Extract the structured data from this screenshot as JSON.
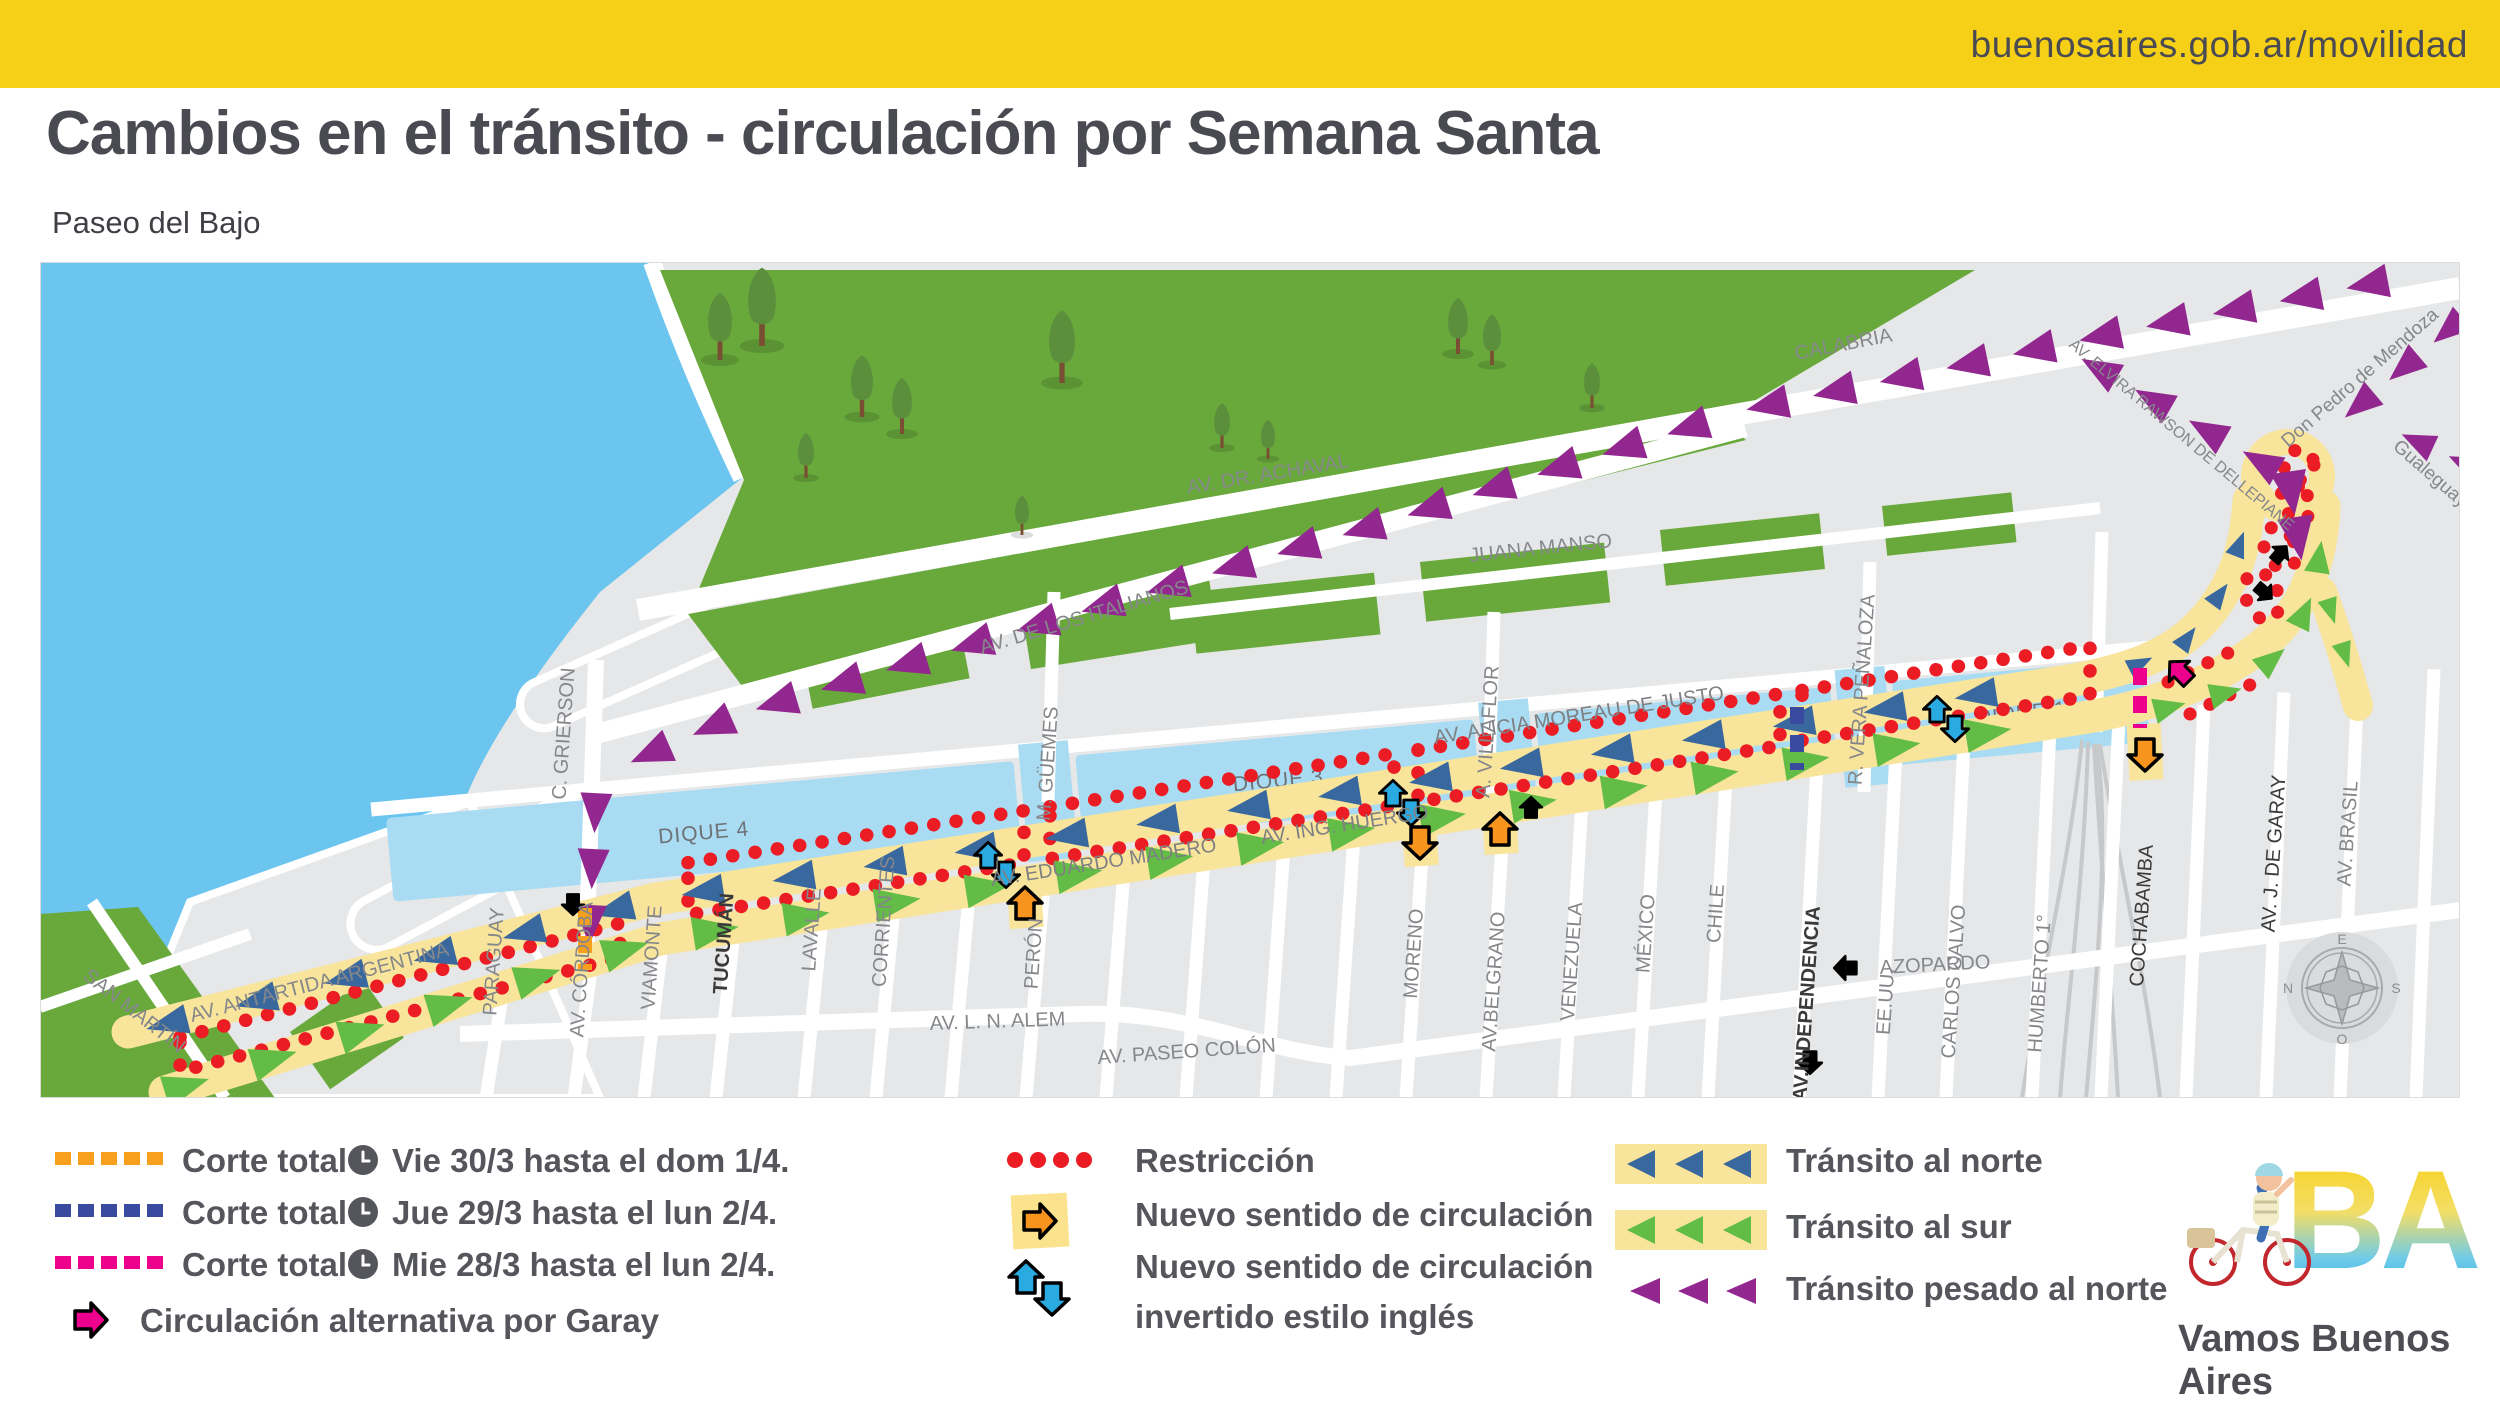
{
  "header": {
    "url": "buenosaires.gob.ar/movilidad"
  },
  "title": "Cambios en el tránsito - circulación por Semana Santa",
  "subtitle": "Paseo del Bajo",
  "colors": {
    "header_yellow": "#F6CF17",
    "road_yellow": "#F8E49B",
    "water": "#6CC5EF",
    "dique_water": "#A9DCF2",
    "park_green": "#69A93C",
    "block_gray": "#E6E7E8",
    "north_blue": "#39689E",
    "south_green": "#62BC46",
    "heavy_purple": "#92278F",
    "restriction_red": "#EC1C24",
    "corte_orange": "#F8A01E",
    "corte_navy": "#3A4A9F",
    "corte_magenta": "#EC008C",
    "arrow_orange": "#F7941E",
    "english_cyan": "#29ABE2"
  },
  "map": {
    "diques": [
      "DIQUE 4",
      "DIQUE 3",
      "DIQUE 2",
      "DIQUE 1"
    ],
    "streets": [
      "SAN MARTÍN",
      "AV. ANTÁRTIDA ARGENTINA",
      "PARAGUAY",
      "AV. CÓRDOBA",
      "VIAMONTE",
      "TUCUMÁN",
      "LAVALLE",
      "CORRIENTES",
      "PERÓN",
      "AV. L. N. ALEM",
      "C. GRIERSON",
      "M. GÜEMES",
      "A. VILLAFLOR",
      "R. VERA PEÑALOZA",
      "AV. EDUARDO MADERO",
      "AV. ING. HUERGO",
      "AV. ALICIA MOREAU DE JUSTO",
      "JUANA MANSO",
      "AV. DR. ACHAVAL",
      "AV. DE LOS ITALIANOS",
      "CALABRIA",
      "AV. ELVIRA RAWSON DE DELLEPIANE",
      "Don Pedro de Mendoza",
      "Gualeguay",
      "MORENO",
      "AV.BELGRANO",
      "VENEZUELA",
      "MÉXICO",
      "CHILE",
      "AV.INDEPENDENCIA",
      "AZOPARDO",
      "EE.UU.",
      "CARLOS CALVO",
      "HUMBERTO 1°",
      "COCHABAMBA",
      "AV. J. DE GARAY",
      "AV. BRASIL",
      "AV. PASEO COLÓN"
    ],
    "compass": {
      "top": "E",
      "left": "N",
      "right": "S",
      "bottom": "O"
    }
  },
  "legend": {
    "cortes": [
      {
        "label": "Corte total",
        "date": "Vie 30/3 hasta el dom 1/4."
      },
      {
        "label": "Corte total",
        "date": "Jue 29/3 hasta el lun 2/4."
      },
      {
        "label": "Corte total",
        "date": "Mie 28/3 hasta el lun 2/4."
      }
    ],
    "alternative": "Circulación alternativa por Garay",
    "restriction": "Restricción",
    "new_direction": "Nuevo sentido de circulación",
    "new_direction_inverted_1": "Nuevo sentido de circulación",
    "new_direction_inverted_2": "invertido estilo inglés",
    "transit_north": "Tránsito al norte",
    "transit_south": "Tránsito al sur",
    "transit_heavy": "Tránsito pesado al norte"
  },
  "logo": {
    "ba": "BA",
    "tagline": "Vamos Buenos Aires"
  }
}
